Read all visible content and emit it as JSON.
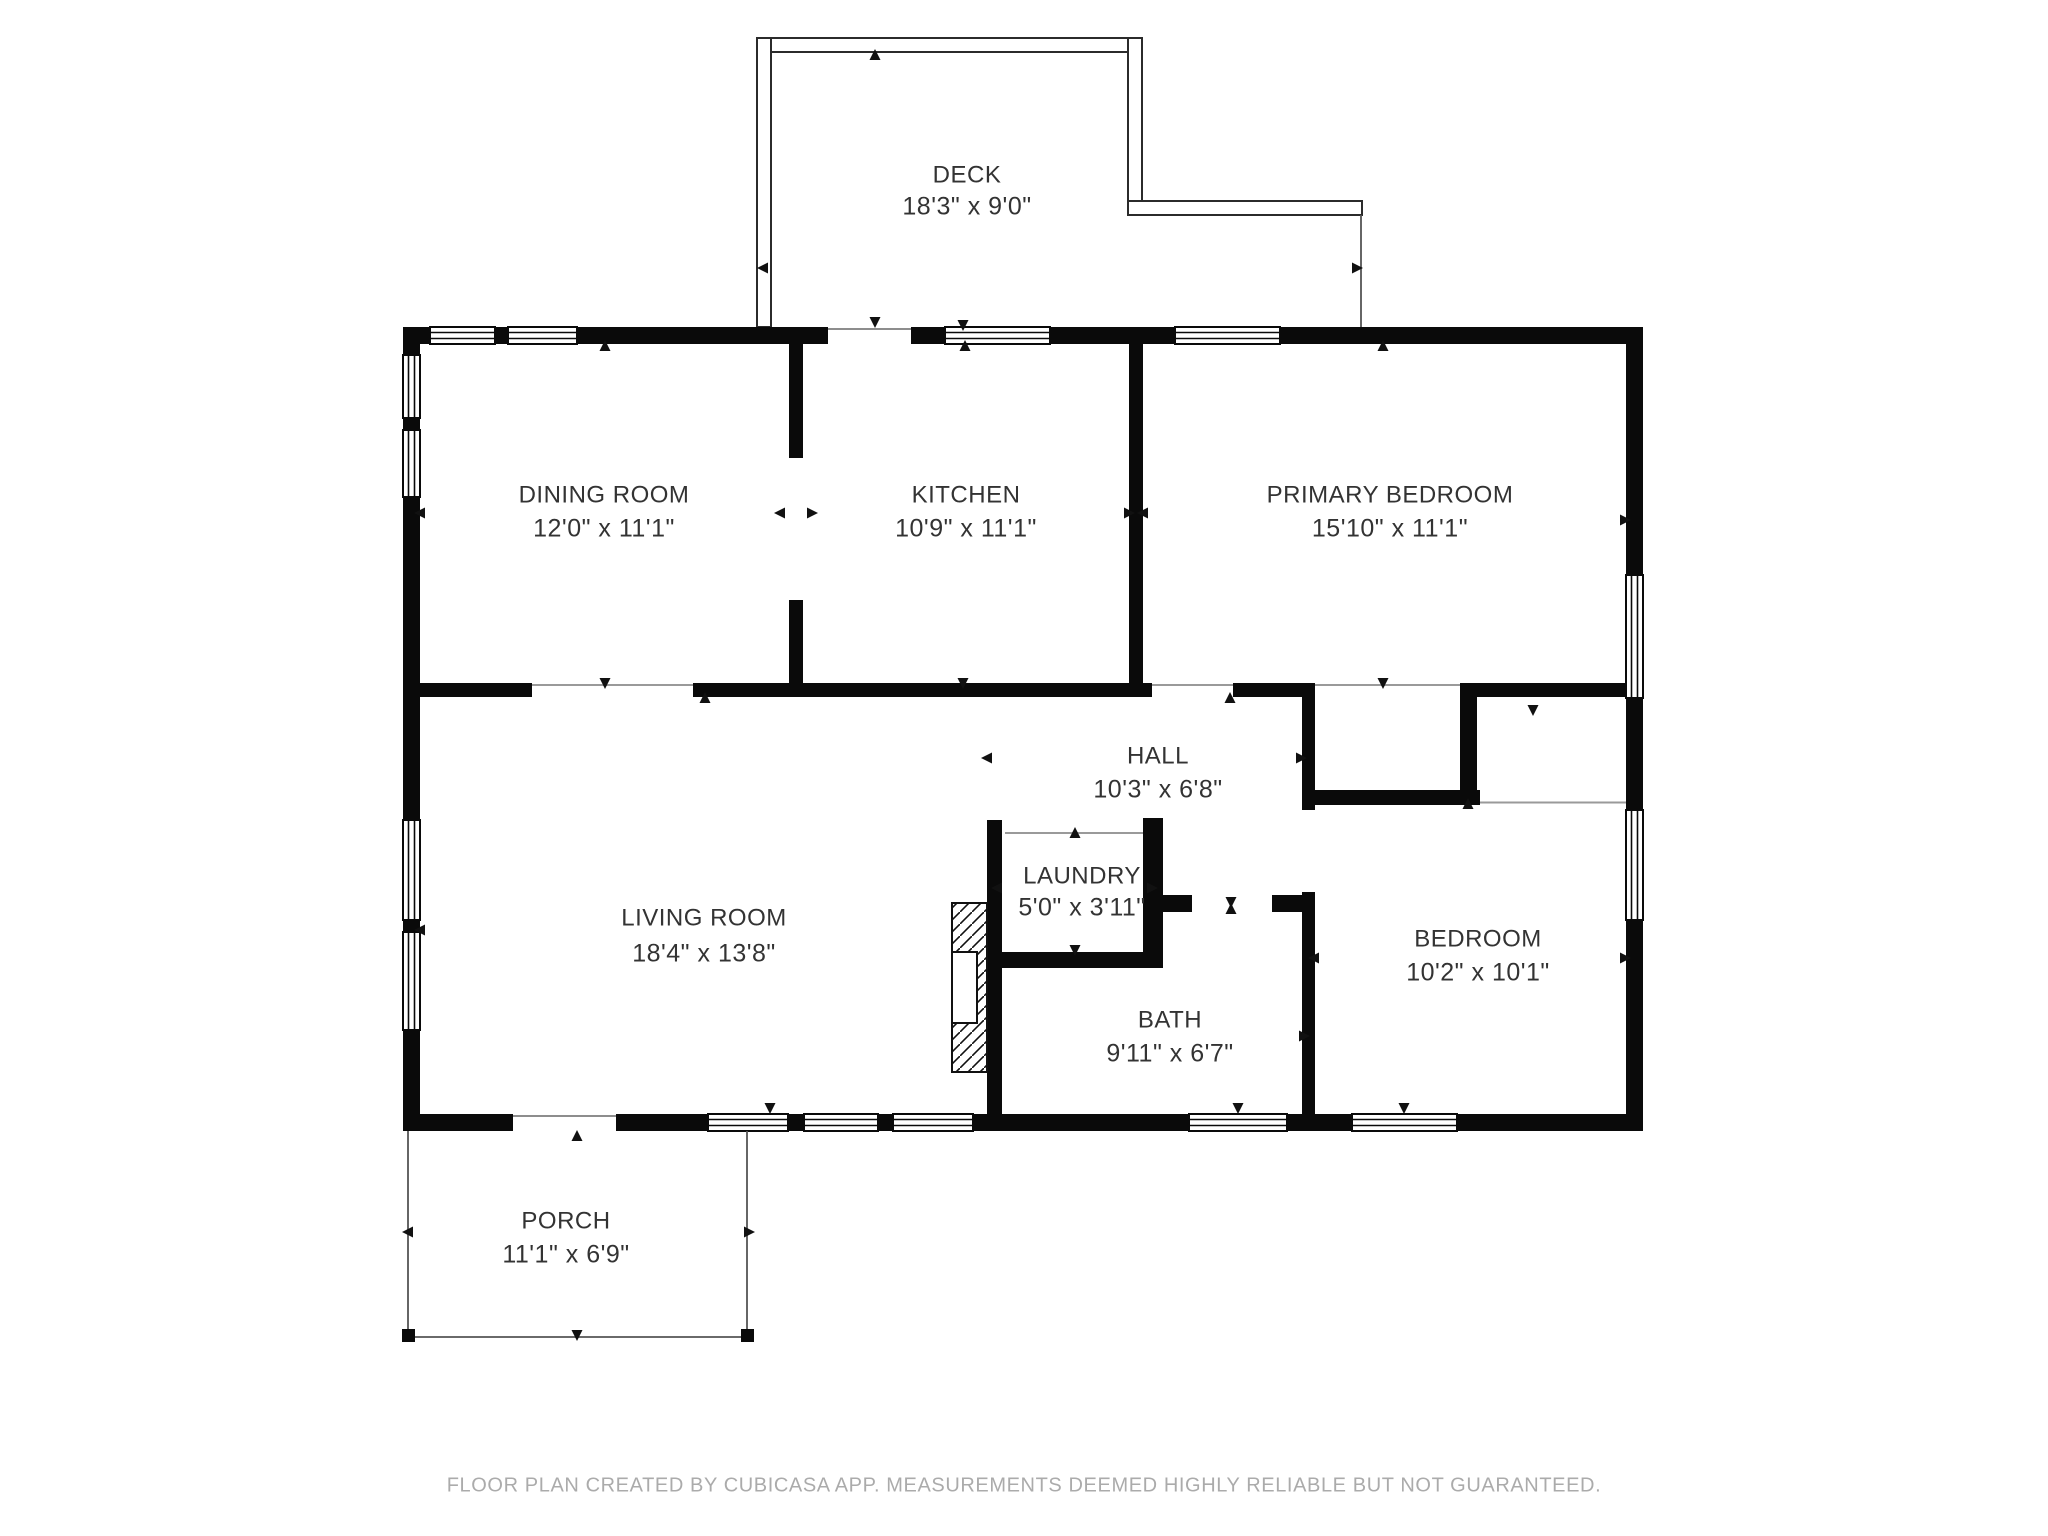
{
  "title": "Floor plan",
  "rooms": [
    {
      "id": "deck",
      "name": "DECK",
      "dims": "18'3\" x 9'0\""
    },
    {
      "id": "dining-room",
      "name": "DINING ROOM",
      "dims": "12'0\" x 11'1\""
    },
    {
      "id": "kitchen",
      "name": "KITCHEN",
      "dims": "10'9\" x 11'1\""
    },
    {
      "id": "primary-bedroom",
      "name": "PRIMARY BEDROOM",
      "dims": "15'10\" x 11'1\""
    },
    {
      "id": "hall",
      "name": "HALL",
      "dims": "10'3\" x 6'8\""
    },
    {
      "id": "living-room",
      "name": "LIVING ROOM",
      "dims": "18'4\" x 13'8\""
    },
    {
      "id": "laundry",
      "name": "LAUNDRY",
      "dims": "5'0\" x 3'11\""
    },
    {
      "id": "bath",
      "name": "BATH",
      "dims": "9'11\" x 6'7\""
    },
    {
      "id": "bedroom",
      "name": "BEDROOM",
      "dims": "10'2\" x 10'1\""
    },
    {
      "id": "porch",
      "name": "PORCH",
      "dims": "11'1\" x 6'9\""
    }
  ],
  "footer": {
    "text": "FLOOR PLAN CREATED BY CUBICASA APP. MEASUREMENTS DEEMED HIGHLY RELIABLE BUT NOT GUARANTEED."
  },
  "colors": {
    "wall": "#0a0a0a",
    "label_text": "#333333",
    "footer_text": "#ababab",
    "background": "#ffffff"
  }
}
